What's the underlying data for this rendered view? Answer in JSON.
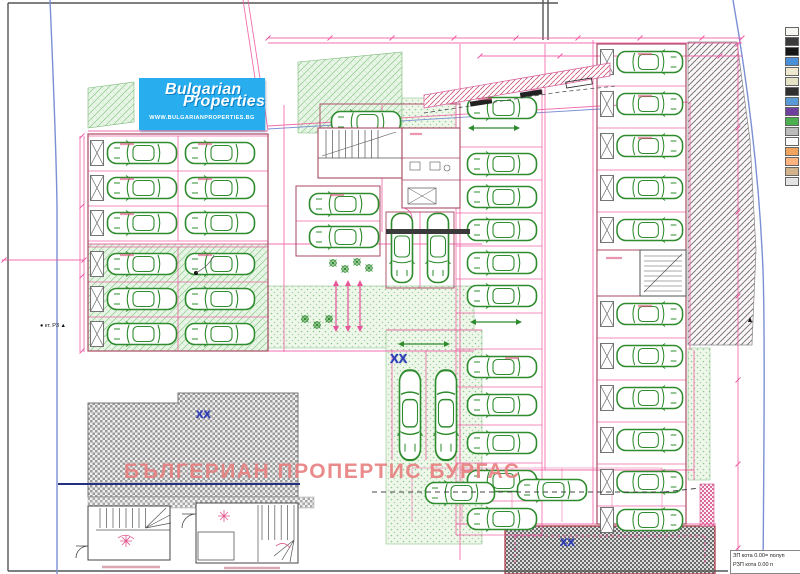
{
  "logo": {
    "line1": "Bulgarian",
    "line2": "Properties",
    "url": "WWW.BULGARIANPROPERTIES.BG",
    "bg": "#28aeef"
  },
  "watermark": {
    "text": "БЪЛГЕРИАН ПРОПЕРТИС БУРГАС",
    "color": "#e87f7f"
  },
  "parcel_marks": {
    "m1": "XX",
    "m2": "XX",
    "m3": "XX",
    "color": "#2b3ab5"
  },
  "survey_label": "● кт. Р3 ▲",
  "note_box": {
    "line1": "ЗП кота 0.00= полуп",
    "line2": "РЗП кота 0.00 п"
  },
  "legend_swatches": [
    "#f7f7f2",
    "#3a3a3a",
    "#161616",
    "#4a90d9",
    "#efe9cf",
    "#e7e3c6",
    "#2f2f2f",
    "#5b9bd5",
    "#6f3fa0",
    "#4caf50",
    "#bdbdbd",
    "#fbfbfb",
    "#f2a35e",
    "#ffb37e",
    "#d2b48c",
    "#e3e3e3"
  ],
  "palette": {
    "dimension_pink": "#f0569f",
    "wall_red": "#a84a63",
    "car_green": "#2e8b2e",
    "hatch_green": "#8cc98c",
    "road_blue": "#7b8fd4",
    "navy_line": "#22307e",
    "frame_gray": "#555555"
  }
}
